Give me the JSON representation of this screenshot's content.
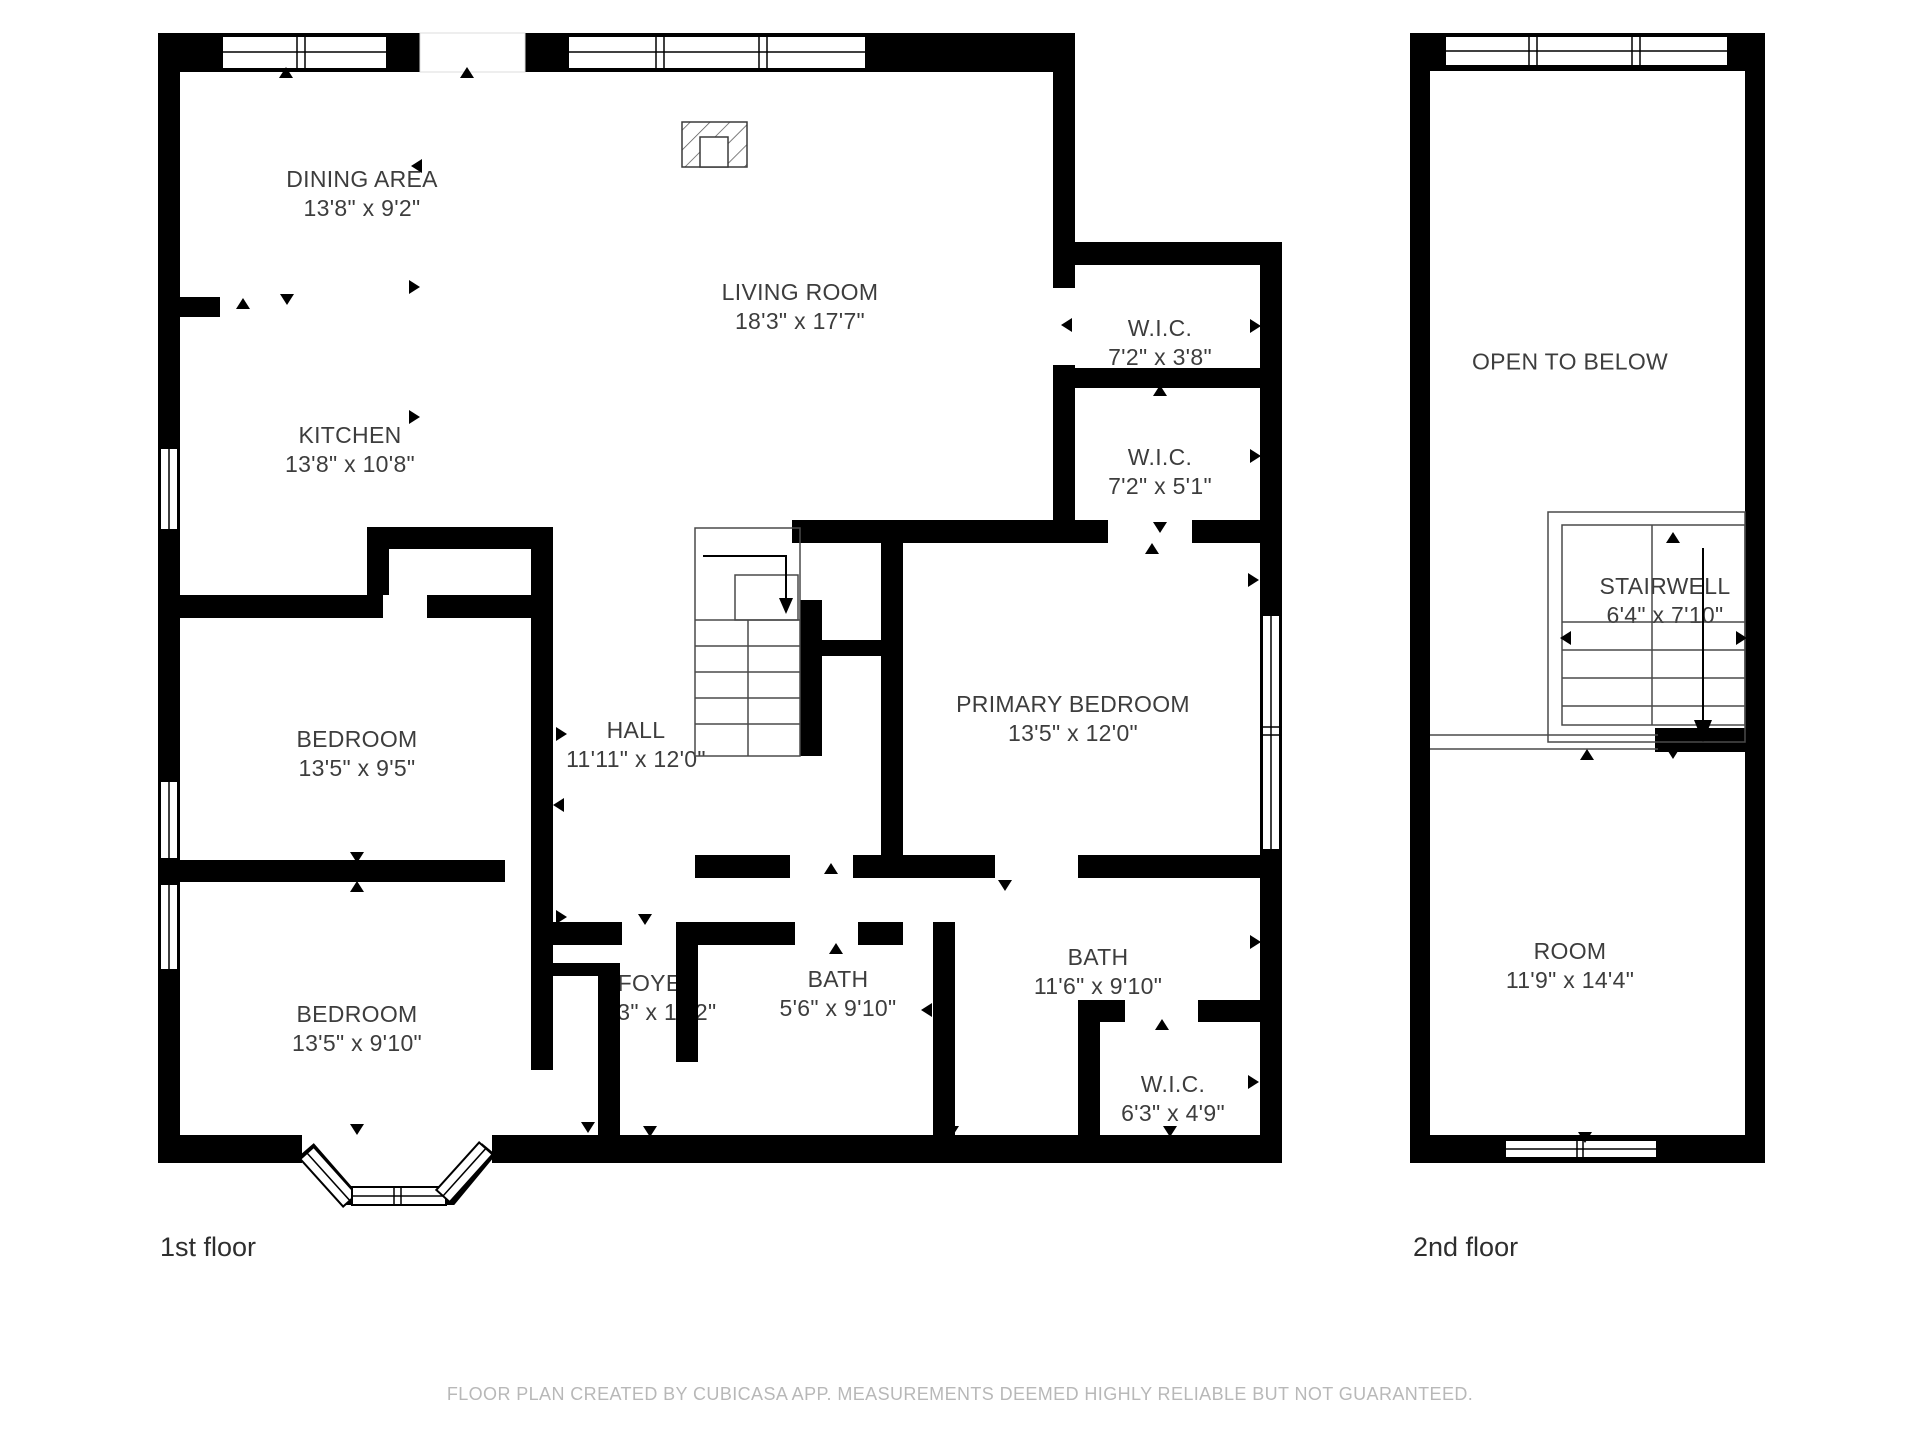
{
  "page": {
    "background": "#ffffff"
  },
  "colors": {
    "wall": "#000000",
    "room_label": "#3d3d3d",
    "floor_caption": "#2e2e2e",
    "footer_text": "#b8b8b8",
    "stair_line": "#4a4a4a"
  },
  "floors": [
    {
      "caption": "1st floor",
      "rooms": [
        {
          "name": "DINING AREA",
          "dims": "13'8\" x 9'2\""
        },
        {
          "name": "LIVING ROOM",
          "dims": "18'3\" x 17'7\""
        },
        {
          "name": "KITCHEN",
          "dims": "13'8\" x 10'8\""
        },
        {
          "name": "W.I.C.",
          "dims": "7'2\" x 3'8\""
        },
        {
          "name": "W.I.C.",
          "dims": "7'2\" x 5'1\""
        },
        {
          "name": "PRIMARY BEDROOM",
          "dims": "13'5\" x 12'0\""
        },
        {
          "name": "HALL",
          "dims": "11'11\" x 12'0\""
        },
        {
          "name": "BEDROOM",
          "dims": "13'5\" x 9'5\""
        },
        {
          "name": "BEDROOM",
          "dims": "13'5\" x 9'10\""
        },
        {
          "name": "FOYER",
          "dims": "5'3\" x 10'2\""
        },
        {
          "name": "BATH",
          "dims": "5'6\" x 9'10\""
        },
        {
          "name": "BATH",
          "dims": "11'6\" x 9'10\""
        },
        {
          "name": "W.I.C.",
          "dims": "6'3\" x 4'9\""
        }
      ]
    },
    {
      "caption": "2nd floor",
      "rooms": [
        {
          "name": "OPEN TO BELOW"
        },
        {
          "name": "STAIRWELL",
          "dims": "6'4\" x 7'10\""
        },
        {
          "name": "ROOM",
          "dims": "11'9\" x 14'4\""
        }
      ]
    }
  ],
  "footer": "FLOOR PLAN CREATED BY CUBICASA APP. MEASUREMENTS DEEMED HIGHLY RELIABLE BUT NOT GUARANTEED."
}
